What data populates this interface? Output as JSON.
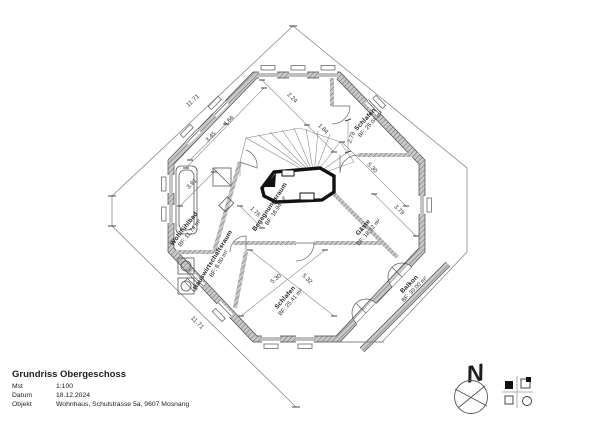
{
  "title_block": {
    "title": "Grundriss Obergeschoss",
    "rows": [
      {
        "label": "Mst",
        "value": "1:100"
      },
      {
        "label": "Datum",
        "value": "18.12.2024"
      },
      {
        "label": "Objekt",
        "value": "Wohnhaus, Schulstrasse 5a, 9607 Mosnang"
      }
    ]
  },
  "north": {
    "label": "N"
  },
  "rooms": [
    {
      "name": "Schlafen",
      "area": "BF: 25.04 m²"
    },
    {
      "name": "Gäste",
      "area": "BF: 18.32 m²"
    },
    {
      "name": "Balkon",
      "area": "BF: 30.00 m²"
    },
    {
      "name": "Schlafen",
      "area": "BF: 25.41 m²"
    },
    {
      "name": "Begegnungsraum",
      "area": "BF: 16.94 m²"
    },
    {
      "name": "Wohlfühlbad",
      "area": "BF: 11.74 m²"
    },
    {
      "name": "Hauswirtschaftsraum",
      "area": "BF: 6.90 m²"
    }
  ],
  "dimensions": [
    {
      "text": "11.71"
    },
    {
      "text": "11.71"
    },
    {
      "text": "2.24"
    },
    {
      "text": "1.84"
    },
    {
      "text": "4.66"
    },
    {
      "text": "3.45"
    },
    {
      "text": "3.91"
    },
    {
      "text": "1.76"
    },
    {
      "text": "2.78"
    },
    {
      "text": "5.30"
    },
    {
      "text": "3.79"
    },
    {
      "text": "5.30"
    },
    {
      "text": "5.32"
    }
  ],
  "legend": {
    "symbols": [
      "filled-square",
      "square-with-chimney",
      "open-square",
      "open-circle"
    ]
  },
  "drawing": {
    "line_color": "#555555",
    "wall_color": "#9a9a9a",
    "text_color": "#1e1e1e"
  }
}
